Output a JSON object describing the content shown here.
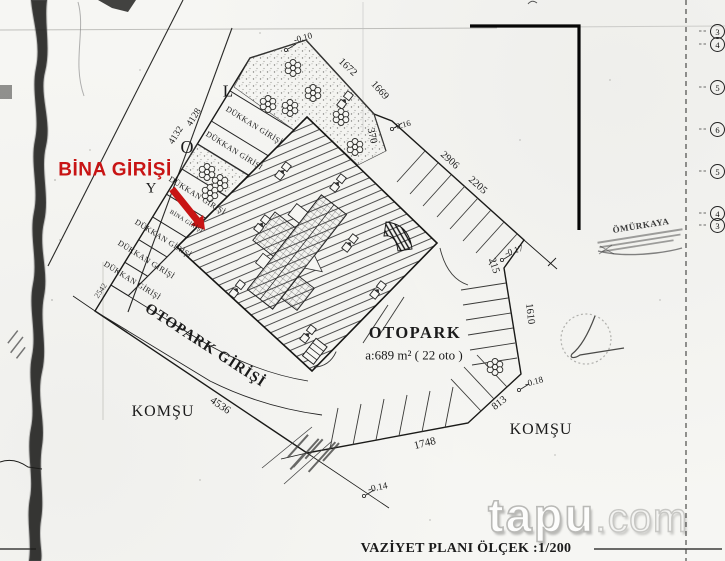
{
  "document": {
    "type_label": "VAZİYET PLANI ÖLÇEK :1/200"
  },
  "annotations": {
    "bina_girisi": "BİNA GİRİŞİ"
  },
  "strips": {
    "dukkan": "DÜKKAN GİRİŞİ",
    "bina": "BİNA GİRİŞİ"
  },
  "road": {
    "y": "Y",
    "o": "O",
    "l": "L"
  },
  "parking": {
    "title": "OTOPARK",
    "area": "a:689 m² ( 22 oto )",
    "entrance": "OTOPARK GİRİŞİ"
  },
  "neighbors": {
    "left": "KOMŞU",
    "right": "KOMŞU"
  },
  "dims": {
    "d010": "-0.10",
    "d1672": "1672",
    "d1669": "1669",
    "d370": "370",
    "d016": "-0.16",
    "d2906": "2906",
    "d2205": "2205",
    "d215": "215",
    "d017": "-0.17",
    "d1610": "1610",
    "d018": "-0.18",
    "d813": "813",
    "d1748": "1748",
    "d014": "-0.14",
    "d4536": "4536",
    "d4132": "4132",
    "d4128": "4128",
    "d2542": "2542"
  },
  "stamp": {
    "name": "ÖMÜRKAYA"
  },
  "ref_numbers": [
    "3",
    "4",
    "5",
    "6",
    "5",
    "4",
    "3"
  ],
  "watermark": {
    "brand": "tapu",
    "tld": ".com"
  },
  "colors": {
    "accent_red": "#c81414",
    "ink": "#1a1a1a",
    "paper": "#f6f6f3"
  }
}
